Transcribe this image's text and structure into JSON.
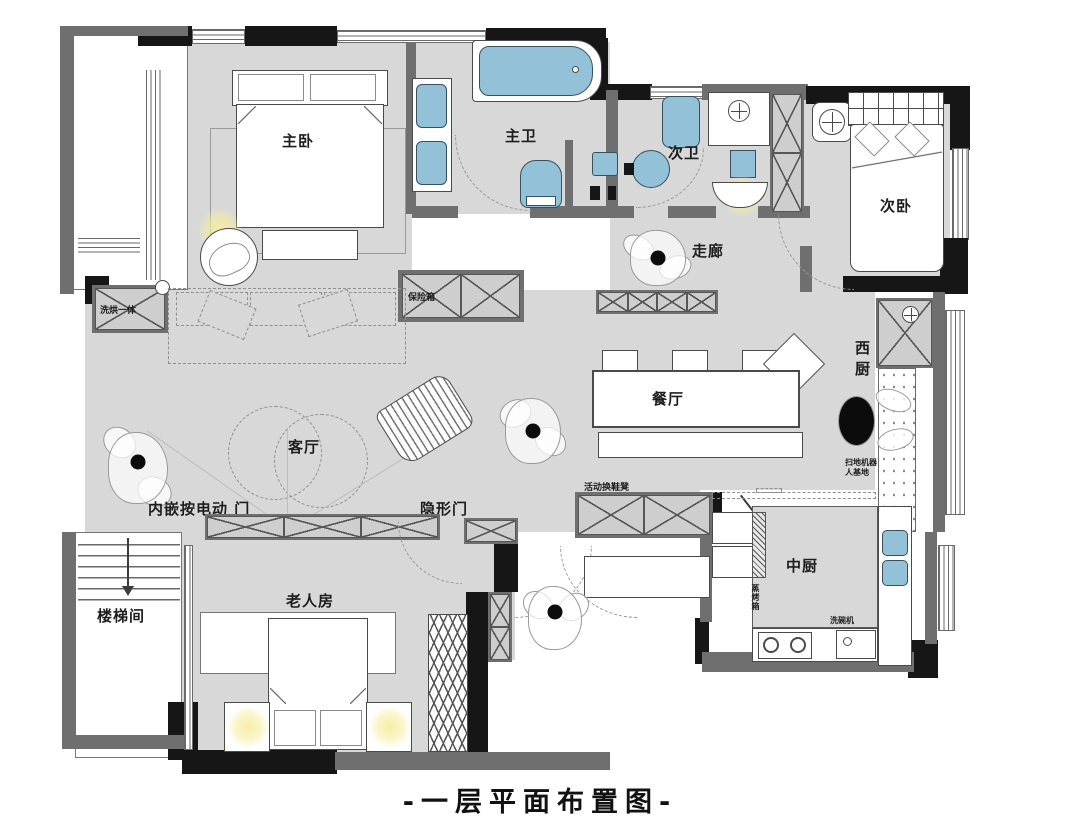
{
  "title": "-一层平面布置图-",
  "rooms": {
    "master_bedroom": "主卧",
    "master_bath": "主卫",
    "second_bath": "次卫",
    "second_bedroom": "次卧",
    "corridor": "走廊",
    "dining_room": "餐厅",
    "living_room": "客厅",
    "elder_room": "老人房",
    "stairwell": "楼梯间",
    "west_kitchen": "西厨",
    "chinese_kitchen": "中厨"
  },
  "annotations": {
    "safe_box": "保险箱",
    "washer_dryer": "洗烘一体",
    "embedded_electric_door": "内嵌按电动 门",
    "hidden_door": "隐形门",
    "movable_shoe_bench": "活动换鞋凳",
    "robot_vacuum_line1": "扫地机器",
    "robot_vacuum_line2": "人基地",
    "steam_oven": "蒸烤箱",
    "dishwasher": "洗碗机"
  },
  "colors": {
    "floor_gray": "#d8d8d8",
    "wall_black": "#161616",
    "wall_gray": "#6f6f6f",
    "fixture_blue": "#93c1d8",
    "lamp_glow": "#f6ee9f"
  }
}
